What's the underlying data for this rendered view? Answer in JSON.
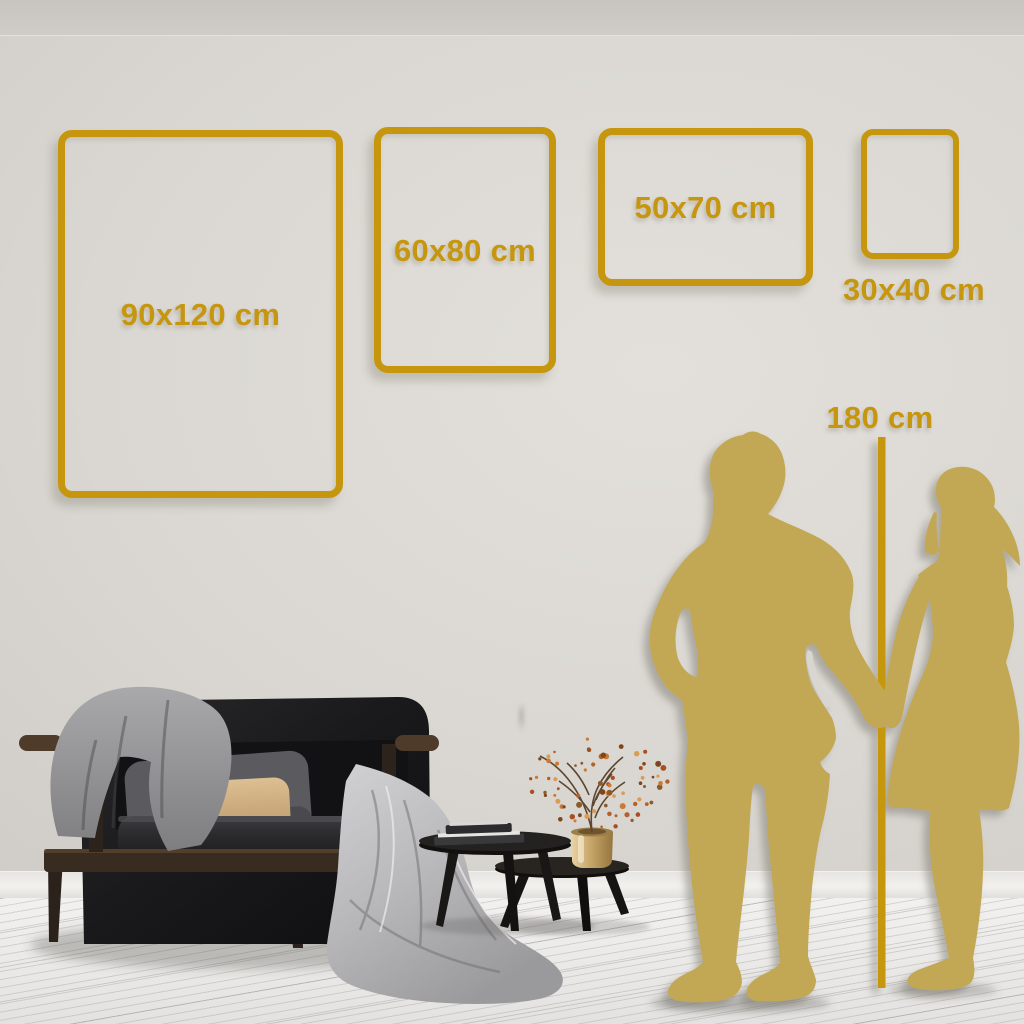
{
  "scene": {
    "accent_color": "#C6960F",
    "silhouette_color": "#C2A855",
    "wall_color": "#D6D3CE",
    "floor_color": "#EDECEA"
  },
  "frames": [
    {
      "label": "90x120 cm"
    },
    {
      "label": "60x80 cm"
    },
    {
      "label": "50x70 cm"
    },
    {
      "label": "30x40 cm"
    }
  ],
  "height_reference": {
    "label": "180 cm"
  },
  "props": [
    "sofa",
    "gray-blanket",
    "throw-pillows",
    "nested-coffee-tables",
    "books",
    "brass-vase",
    "dried-branch",
    "man-silhouette",
    "woman-silhouette"
  ]
}
